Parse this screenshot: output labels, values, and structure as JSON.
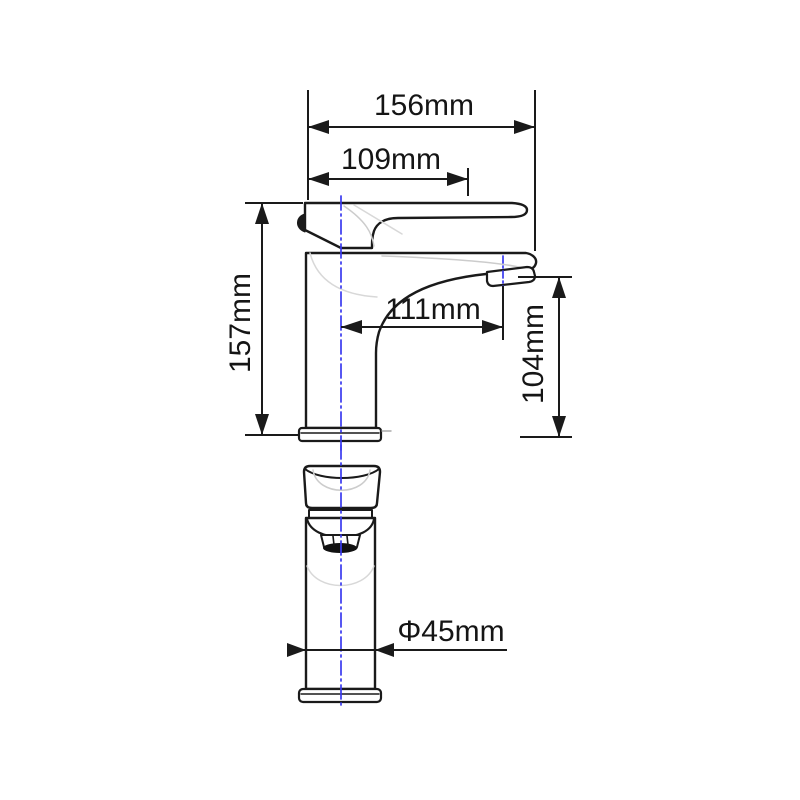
{
  "drawing": {
    "type": "faucet-technical-dimension-drawing",
    "views": {
      "side_view": "faucet side elevation with handle and spout",
      "front_view": "faucet front elevation with aerator and base"
    },
    "dimensions": {
      "overall_length": "156mm",
      "handle_length": "109mm",
      "total_height": "157mm",
      "spout_reach": "111mm",
      "spout_height": "104mm",
      "base_diameter": "Φ45mm"
    },
    "colors": {
      "outline": "#1a1a1a",
      "dimension_lines": "#1a1a1a",
      "centerline_blue": "#3a3aef",
      "highlight_gray": "#cccccc",
      "background": "#ffffff"
    }
  }
}
